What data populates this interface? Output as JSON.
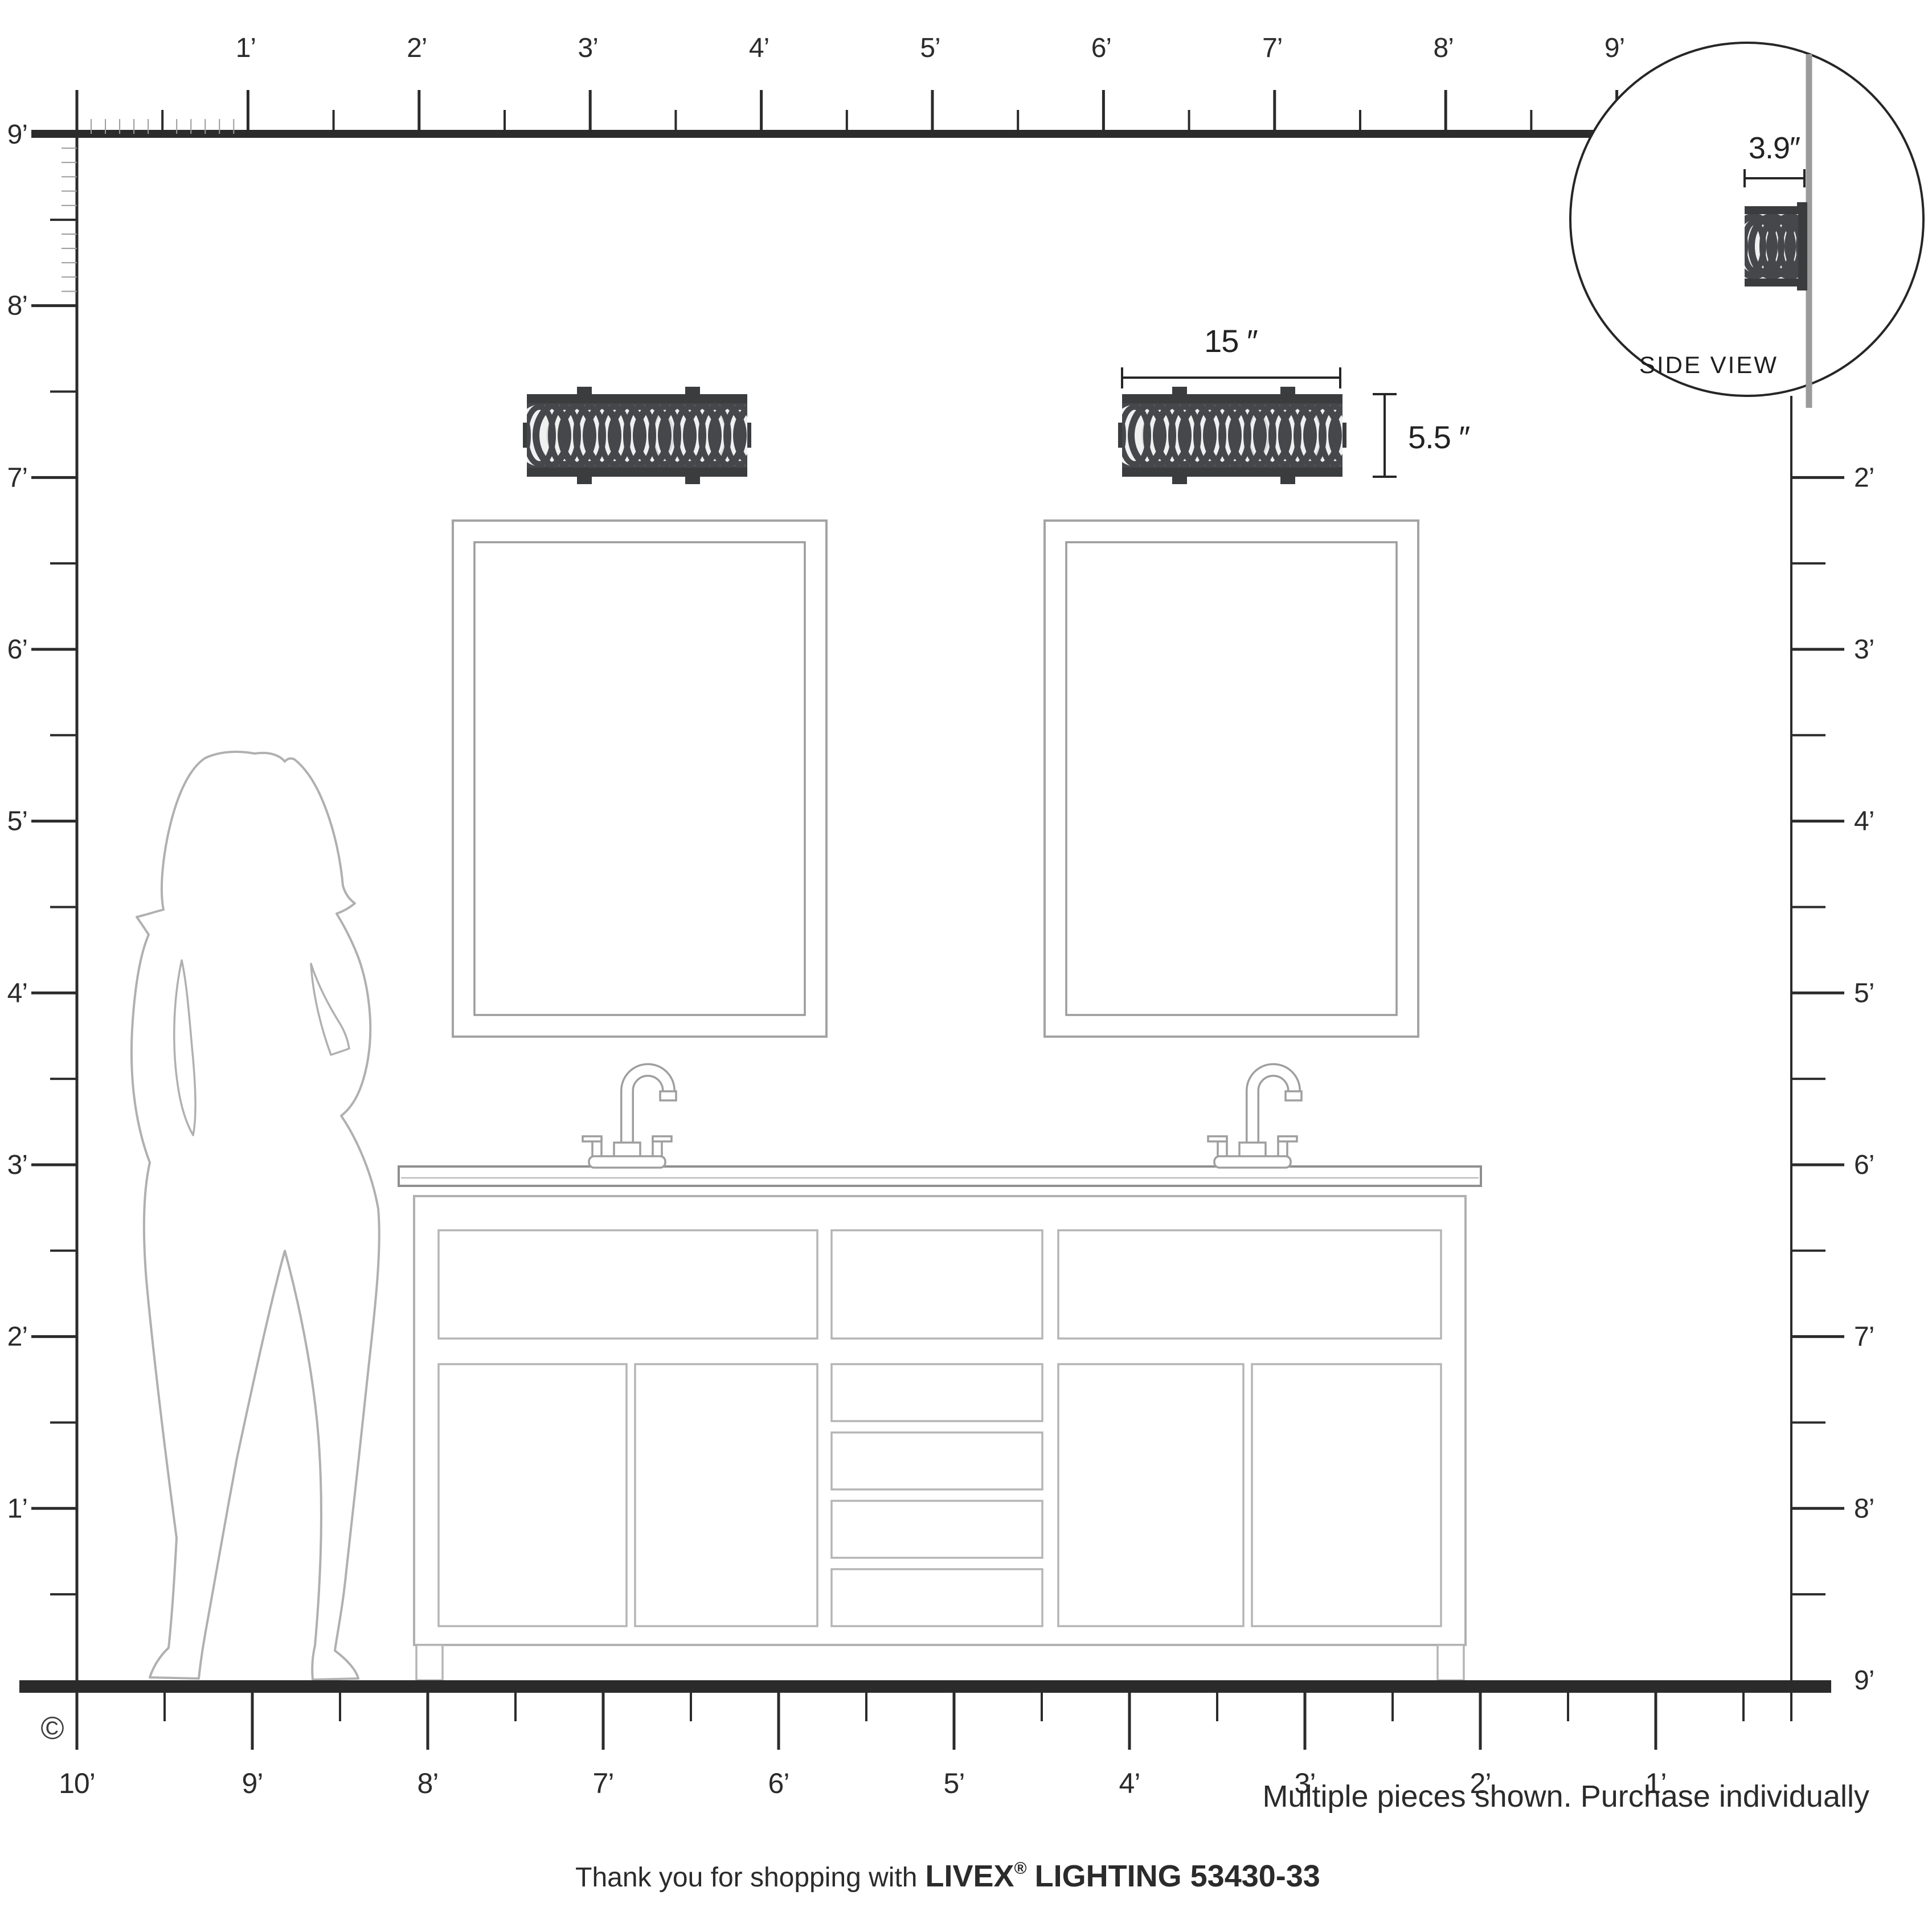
{
  "product": {
    "brand": "LIVEX",
    "reg": "®",
    "suffix": "LIGHTING 53430-33"
  },
  "dimensions": {
    "width_label": "15 ″",
    "height_label": "5.5 ″",
    "depth_label": "3.9″"
  },
  "side_view": {
    "label": "SIDE VIEW"
  },
  "rulers": {
    "top": {
      "labels": [
        "1’",
        "2’",
        "3’",
        "4’",
        "5’",
        "6’",
        "7’",
        "8’",
        "9’"
      ]
    },
    "left": {
      "labels": [
        "9’",
        "8’",
        "7’",
        "6’",
        "5’",
        "4’",
        "3’",
        "2’",
        "1’"
      ]
    },
    "right": {
      "labels": [
        "2’",
        "3’",
        "4’",
        "5’",
        "6’",
        "7’",
        "8’",
        "9’"
      ]
    },
    "bottom": {
      "labels": [
        "10’",
        "9’",
        "8’",
        "7’",
        "6’",
        "5’",
        "4’",
        "3’",
        "2’",
        "1’"
      ]
    }
  },
  "notes": {
    "purchase_note": "Multiple pieces shown. Purchase individually",
    "thanks_prefix": "Thank you for shopping with",
    "copyright": "©"
  },
  "colors": {
    "ink": "#262626",
    "fixture_dark": "#3a3c3e",
    "lattice": "#45474a",
    "wall_gray": "#9b9b9b",
    "figure_gray": "#b0b0b0",
    "diffuser": "#f0f0f1"
  }
}
